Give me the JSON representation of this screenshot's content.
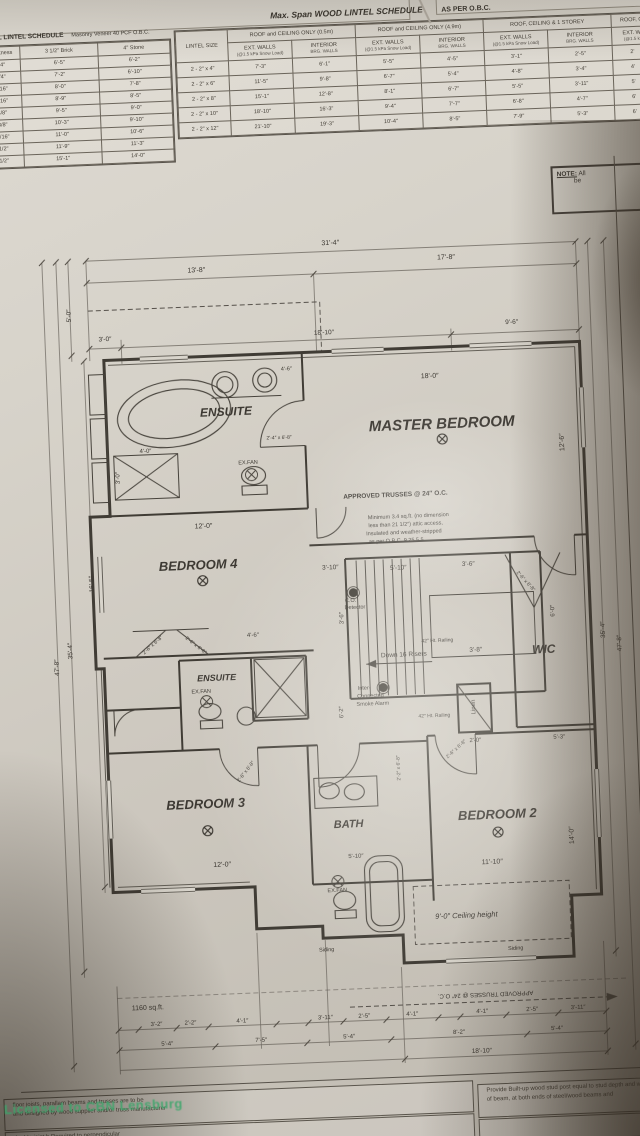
{
  "photo": {
    "watermark": "Licensed to CBN Lensburg"
  },
  "top_strip": {
    "fragment": "4.1"
  },
  "note_box": {
    "line1": "NOTE:",
    "line1b": "All",
    "line2": "be"
  },
  "wood_lintel_schedule": {
    "title": "Max. Span WOOD LINTEL SCHEDULE",
    "suffix": "AS PER O.B.C.",
    "lintel_size_header": "LINTEL SIZE",
    "groups": [
      {
        "label": "ROOF and CEILING ONLY  (0.5m)",
        "subs": [
          {
            "t": "EXT. WALLS",
            "note": "(@1.5 kPa Snow Load)"
          },
          {
            "t": "INTERIOR",
            "note": "BRG. WALLS"
          }
        ]
      },
      {
        "label": "ROOF and CEILING ONLY  (4.9m)",
        "subs": [
          {
            "t": "EXT. WALLS",
            "note": "(@1.5 kPa Snow Load)"
          },
          {
            "t": "INTERIOR",
            "note": "BRG. WALLS"
          }
        ]
      },
      {
        "label": "ROOF, CEILING & 1 STOREY",
        "subs": [
          {
            "t": "EXT. WALLS",
            "note": "(@1.5 kPa Snow Load)"
          },
          {
            "t": "INTERIOR",
            "note": "BRG. WALLS"
          }
        ]
      },
      {
        "label": "ROOF, C",
        "subs": [
          {
            "t": "EXT. W",
            "note": "(@1.5 k"
          }
        ]
      }
    ],
    "rows": [
      [
        "2 - 2\" x 4\"",
        "7'-3\"",
        "6'-1\"",
        "5'-5\"",
        "4'-5\"",
        "3'-1\"",
        "2'-5\"",
        "2'"
      ],
      [
        "2 - 2\" x 6\"",
        "11'-5\"",
        "9'-8\"",
        "6'-7\"",
        "5'-4\"",
        "4'-8\"",
        "3'-4\"",
        "4'"
      ],
      [
        "2 - 2\" x 8\"",
        "15'-1\"",
        "12'-8\"",
        "8'-1\"",
        "6'-7\"",
        "5'-5\"",
        "3'-11\"",
        "5'"
      ],
      [
        "2 - 2\" x 10\"",
        "18'-10\"",
        "16'-3\"",
        "9'-4\"",
        "7'-7\"",
        "6'-8\"",
        "4'-7\"",
        "6'"
      ],
      [
        "2 - 2\" x 12\"",
        "21'-10\"",
        "19'-3\"",
        "10'-4\"",
        "8'-5\"",
        "7'-9\"",
        "5'-3\"",
        "6'"
      ]
    ]
  },
  "steel_lintel_schedule": {
    "title": "STEEL LINTEL SCHEDULE",
    "subtitle": "Masonry Veneer 40 PCF O.B.C.",
    "columns": [
      "Horiz. Leg",
      "Thickness",
      "3 1/2\" Brick",
      "4\" Stone"
    ],
    "rows": [
      [
        "3 1/2\"",
        "1/4\"",
        "6'-5\"",
        "6'-2\""
      ],
      [
        "3 1/2\"",
        "1/4\"",
        "7'-2\"",
        "6'-10\""
      ],
      [
        "3 1/2\"",
        "5/16\"",
        "8'-0\"",
        "7'-8\""
      ],
      [
        "3 1/2\"",
        "5/16\"",
        "8'-9\"",
        "8'-5\""
      ],
      [
        "3 1/2\"",
        "3/8\"",
        "9'-5\"",
        "9'-0\""
      ],
      [
        "3 1/2\"",
        "3/8\"",
        "10'-3\"",
        "9'-10\""
      ],
      [
        "3 1/2\"",
        "7/16\"",
        "11'-0\"",
        "10'-6\""
      ],
      [
        "3 1/2\"",
        "1/2\"",
        "11'-9\"",
        "11'-3\""
      ],
      [
        "4\"",
        "1/2\"",
        "15'-1\"",
        "14'-0\""
      ]
    ]
  },
  "bottom_notes": {
    "left_box": [
      "floor joists, parallam beams and trusses are to be",
      "and designed by wood supplier and/or truss manufacturer"
    ],
    "left_box2": [
      "double joist h          Required to          perpendicular"
    ],
    "right_box": [
      "Provide  Built-up wood stud post equal to stud depth and width",
      "of beam, at both ends of steel/wood beams and"
    ]
  },
  "plan": {
    "labels": [
      {
        "t": "ENSUITE",
        "x": 232,
        "y": 408,
        "s": 12,
        "b": 1,
        "i": 1,
        "n": "room-label-ensuite-master"
      },
      {
        "t": "MASTER BEDROOM",
        "x": 447,
        "y": 429,
        "s": 15,
        "b": 1,
        "i": 1,
        "n": "room-label-master-bedroom"
      },
      {
        "t": "BEDROOM 4",
        "x": 198,
        "y": 560,
        "s": 13,
        "b": 1,
        "i": 1,
        "n": "room-label-bedroom-4"
      },
      {
        "t": "ENSUITE",
        "x": 212,
        "y": 674,
        "s": 9,
        "b": 1,
        "i": 1,
        "n": "room-label-ensuite-2"
      },
      {
        "t": "WIC",
        "x": 540,
        "y": 658,
        "s": 12,
        "b": 1,
        "i": 1,
        "n": "room-label-wic"
      },
      {
        "t": "BEDROOM 3",
        "x": 196,
        "y": 799,
        "s": 13,
        "b": 1,
        "i": 1,
        "n": "room-label-bedroom-3"
      },
      {
        "t": "BATH",
        "x": 338,
        "y": 826,
        "s": 11,
        "b": 1,
        "i": 1,
        "n": "room-label-bath"
      },
      {
        "t": "BEDROOM 2",
        "x": 487,
        "y": 821,
        "s": 13,
        "b": 1,
        "i": 1,
        "n": "room-label-bedroom-2"
      },
      {
        "t": "Linen",
        "x": 468,
        "y": 713,
        "s": 6,
        "r": -90,
        "n": "room-label-linen"
      },
      {
        "t": "APPROVED TRUSSES @ 24″ O.C.",
        "x": 398,
        "y": 499,
        "s": 6.5,
        "b": 1,
        "n": "note-approved-trusses"
      },
      {
        "t": "Minimum 3.4 sq.ft. (no dimension",
        "x": 410,
        "y": 521,
        "s": 5.5,
        "n": "note-attic-access"
      },
      {
        "t": "less than 21 1/2″) attic access,",
        "x": 407,
        "y": 529,
        "s": 5.5,
        "n": "note-attic-access"
      },
      {
        "t": "Insulated and weather-stripped",
        "x": 405,
        "y": 537,
        "s": 5.5,
        "n": "note-attic-access"
      },
      {
        "t": "as per O.B.C. 9.25.5.5",
        "x": 397,
        "y": 545,
        "s": 5.5,
        "n": "note-attic-access"
      },
      {
        "t": "C.O.",
        "x": 349,
        "y": 603,
        "s": 5.5,
        "n": "note-co-detector"
      },
      {
        "t": "Detector",
        "x": 353,
        "y": 610,
        "s": 5.5,
        "n": "note-co-detector"
      },
      {
        "t": "Inter-",
        "x": 359,
        "y": 691,
        "s": 5.5,
        "n": "note-smoke-alarm"
      },
      {
        "t": "Connected",
        "x": 365,
        "y": 699,
        "s": 5.5,
        "n": "note-smoke-alarm"
      },
      {
        "t": "Smoke Alarm",
        "x": 367,
        "y": 707,
        "s": 5.5,
        "n": "note-smoke-alarm"
      },
      {
        "t": "Down 16 Risers",
        "x": 400,
        "y": 659,
        "s": 6.5,
        "n": "note-stairs-down"
      },
      {
        "t": "42″ Ht. Railing",
        "x": 434,
        "y": 646,
        "s": 5,
        "n": "note-railing"
      },
      {
        "t": "42″ Ht. Railing",
        "x": 428,
        "y": 721,
        "s": 5,
        "n": "note-railing"
      },
      {
        "t": "EX.FAN",
        "x": 252,
        "y": 461,
        "s": 5.5,
        "n": "note-exfan"
      },
      {
        "t": "EX.FAN",
        "x": 196,
        "y": 688,
        "s": 5.5,
        "n": "note-exfan"
      },
      {
        "t": "EX.FAN",
        "x": 324,
        "y": 892,
        "s": 5.5,
        "n": "note-exfan"
      },
      {
        "t": "9'-0″ Ceiling height",
        "x": 452,
        "y": 921,
        "s": 7.5,
        "i": 1,
        "n": "note-ceiling-height"
      },
      {
        "t": "Siding",
        "x": 311,
        "y": 951,
        "s": 5.5,
        "n": "note-siding"
      },
      {
        "t": "Siding",
        "x": 500,
        "y": 957,
        "s": 5.5,
        "n": "note-siding"
      },
      {
        "t": "APPROVED TRUSSES @ 24″ O.C.",
        "x": 468,
        "y": 1000,
        "s": 6,
        "r": 180,
        "n": "note-approved-trusses"
      },
      {
        "t": "1160 sq.ft.",
        "x": 130,
        "y": 1001,
        "s": 7,
        "n": "note-area"
      },
      {
        "t": "4.1",
        "x": 14,
        "y": 40,
        "s": 6,
        "n": "text-fragment"
      },
      {
        "t": "31'-4″",
        "x": 343,
        "y": 244,
        "s": 7,
        "n": "dim-label"
      },
      {
        "t": "13'-8″",
        "x": 208,
        "y": 266,
        "s": 7,
        "n": "dim-label"
      },
      {
        "t": "17'-8″",
        "x": 458,
        "y": 263,
        "s": 7,
        "n": "dim-label"
      },
      {
        "t": "3'-0″",
        "x": 114,
        "y": 332,
        "s": 6.5,
        "n": "dim-label"
      },
      {
        "t": "18'-10″",
        "x": 333,
        "y": 334,
        "s": 6.5,
        "n": "dim-label"
      },
      {
        "t": "9'-6″",
        "x": 521,
        "y": 331,
        "s": 6.5,
        "n": "dim-label"
      },
      {
        "t": "18'-0″",
        "x": 437,
        "y": 381,
        "s": 7,
        "n": "dim-label"
      },
      {
        "t": "12'-6″",
        "x": 567,
        "y": 452,
        "s": 7,
        "r": -90,
        "n": "dim-label"
      },
      {
        "t": "12'-0″",
        "x": 205,
        "y": 522,
        "s": 7,
        "n": "dim-label"
      },
      {
        "t": "12'-0″",
        "x": 210,
        "y": 861,
        "s": 7,
        "n": "dim-label"
      },
      {
        "t": "11'-10″",
        "x": 480,
        "y": 869,
        "s": 7,
        "n": "dim-label"
      },
      {
        "t": "14'-0″",
        "x": 561,
        "y": 845,
        "s": 7,
        "r": -90,
        "n": "dim-label"
      },
      {
        "t": "5'-0″",
        "x": 80,
        "y": 306,
        "s": 6.5,
        "r": -90,
        "n": "dim-label"
      },
      {
        "t": "16'-5″",
        "x": 92,
        "y": 575,
        "s": 6.5,
        "r": -90,
        "n": "dim-label"
      },
      {
        "t": "35'-4″",
        "x": 68,
        "y": 641,
        "s": 6.5,
        "r": -90,
        "n": "dim-label"
      },
      {
        "t": "47'-8″",
        "x": 54,
        "y": 657,
        "s": 6.5,
        "r": -90,
        "n": "dim-label"
      },
      {
        "t": "35'-4″",
        "x": 601,
        "y": 641,
        "s": 6.5,
        "r": -90,
        "n": "dim-label"
      },
      {
        "t": "47'-8″",
        "x": 617,
        "y": 655,
        "s": 6.5,
        "r": -90,
        "n": "dim-label"
      },
      {
        "t": "5'-10″",
        "x": 398,
        "y": 572,
        "s": 6.5,
        "n": "dim-label"
      },
      {
        "t": "3'-6″",
        "x": 468,
        "y": 571,
        "s": 6.5,
        "n": "dim-label"
      },
      {
        "t": "3'-8″",
        "x": 472,
        "y": 657,
        "s": 6.5,
        "n": "dim-label"
      },
      {
        "t": "3'-10″",
        "x": 330,
        "y": 569,
        "s": 6.5,
        "n": "dim-label"
      },
      {
        "t": "3'-6″",
        "x": 340,
        "y": 619,
        "s": 6,
        "r": -90,
        "n": "dim-label"
      },
      {
        "t": "2'-0″",
        "x": 468,
        "y": 747,
        "s": 6,
        "n": "dim-label"
      },
      {
        "t": "6'-2″",
        "x": 336,
        "y": 713,
        "s": 6,
        "r": -90,
        "n": "dim-label"
      },
      {
        "t": "6'-0″",
        "x": 551,
        "y": 620,
        "s": 6,
        "r": -90,
        "n": "dim-label"
      },
      {
        "t": "4'-6″",
        "x": 250,
        "y": 633,
        "s": 6,
        "n": "dim-label"
      },
      {
        "t": "4'-6″",
        "x": 294,
        "y": 369,
        "s": 5.5,
        "n": "dim-label"
      },
      {
        "t": "4'-0″",
        "x": 150,
        "y": 445,
        "s": 6,
        "n": "dim-label"
      },
      {
        "t": "3'-0″",
        "x": 122,
        "y": 470,
        "s": 6,
        "r": -90,
        "n": "dim-label"
      },
      {
        "t": "5'-3″",
        "x": 552,
        "y": 747,
        "s": 6,
        "n": "dim-label"
      },
      {
        "t": "5'-10″",
        "x": 344,
        "y": 858,
        "s": 6,
        "n": "dim-label"
      },
      {
        "t": "2'-4″ x 6'-8″",
        "x": 284,
        "y": 437,
        "s": 5,
        "n": "door-size-label"
      },
      {
        "t": "2'-6″ x 6'-8″",
        "x": 150,
        "y": 639,
        "s": 5,
        "r": -40,
        "n": "door-size-label"
      },
      {
        "t": "2'-6″ x 6'-8″",
        "x": 192,
        "y": 641,
        "s": 5,
        "r": 40,
        "n": "door-size-label"
      },
      {
        "t": "2'-6″ x 6'-8″",
        "x": 449,
        "y": 755,
        "s": 5,
        "r": -40,
        "n": "door-size-label"
      },
      {
        "t": "2'-2″ x 6'-8″",
        "x": 391,
        "y": 771,
        "s": 5,
        "r": -90,
        "n": "door-size-label"
      },
      {
        "t": "2'-6″ x 6'-8″",
        "x": 238,
        "y": 769,
        "s": 5,
        "r": -50,
        "n": "door-size-label"
      },
      {
        "t": "2'-6″ x 6'-8″",
        "x": 524,
        "y": 590,
        "s": 5,
        "r": 50,
        "n": "door-size-label"
      },
      {
        "t": "3'-2″",
        "x": 138,
        "y": 1018,
        "s": 6,
        "n": "dim-label"
      },
      {
        "t": "2'-2″",
        "x": 172,
        "y": 1018,
        "s": 6,
        "n": "dim-label"
      },
      {
        "t": "4'-1″",
        "x": 224,
        "y": 1018,
        "s": 6,
        "n": "dim-label"
      },
      {
        "t": "3'-11″",
        "x": 307,
        "y": 1018,
        "s": 6,
        "n": "dim-label"
      },
      {
        "t": "2'-5″",
        "x": 346,
        "y": 1018,
        "s": 6,
        "n": "dim-label"
      },
      {
        "t": "4'-1″",
        "x": 394,
        "y": 1018,
        "s": 6,
        "n": "dim-label"
      },
      {
        "t": "4'-1″",
        "x": 464,
        "y": 1018,
        "s": 6,
        "n": "dim-label"
      },
      {
        "t": "2'-5″",
        "x": 514,
        "y": 1018,
        "s": 6,
        "n": "dim-label"
      },
      {
        "t": "3'-11″",
        "x": 560,
        "y": 1018,
        "s": 6,
        "n": "dim-label"
      },
      {
        "t": "5'-4″",
        "x": 148,
        "y": 1038,
        "s": 6,
        "n": "dim-label"
      },
      {
        "t": "7'-5″",
        "x": 242,
        "y": 1038,
        "s": 6,
        "n": "dim-label"
      },
      {
        "t": "5'-4″",
        "x": 330,
        "y": 1038,
        "s": 6,
        "n": "dim-label"
      },
      {
        "t": "8'-2″",
        "x": 440,
        "y": 1038,
        "s": 6,
        "n": "dim-label"
      },
      {
        "t": "5'-4″",
        "x": 538,
        "y": 1038,
        "s": 6,
        "n": "dim-label"
      },
      {
        "t": "18'-10″",
        "x": 462,
        "y": 1058,
        "s": 6.5,
        "n": "dim-label"
      }
    ]
  }
}
